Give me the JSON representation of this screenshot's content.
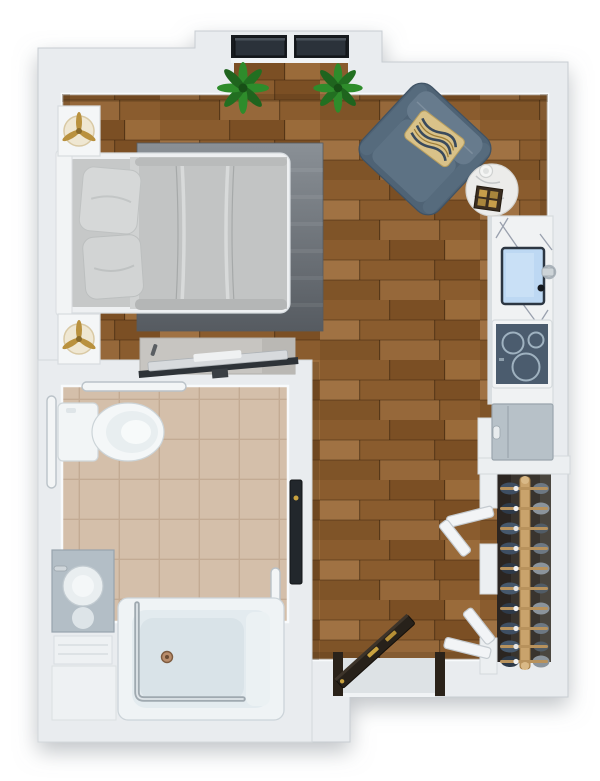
{
  "scene": {
    "type": "apartment-floor-plan-top-view",
    "description": "3D rendered top-down studio apartment floor plan, no text labels",
    "rooms": [
      {
        "name": "main-living-bedroom",
        "floor": "hardwood"
      },
      {
        "name": "bathroom",
        "floor": "beige-tile"
      },
      {
        "name": "closet",
        "floor": "dark"
      },
      {
        "name": "kitchenette",
        "floor": "hardwood"
      },
      {
        "name": "entry",
        "floor": "hardwood"
      }
    ],
    "furniture": [
      "bed",
      "headboard",
      "pillows",
      "area-rug",
      "nightstand-top",
      "nightstand-bottom",
      "table-lamp-top",
      "table-lamp-bottom",
      "tv-console",
      "television",
      "armchair",
      "accent-pillow",
      "side-table",
      "serving-tray",
      "coffee-cup",
      "potted-plant-left",
      "potted-plant-right",
      "window-left",
      "window-right",
      "kitchen-counter",
      "kitchen-sink",
      "kitchen-faucet",
      "cooktop",
      "refrigerator",
      "closet-rod",
      "clothes-on-hangers",
      "bifold-door-upper",
      "bifold-door-lower",
      "entry-door",
      "bathroom-door",
      "toilet",
      "grab-bar-top",
      "grab-bar-left",
      "grab-bar-right",
      "tub-grab-bar",
      "vanity",
      "vanity-basin",
      "walk-in-bathtub",
      "tub-drain",
      "towel-shelf"
    ]
  },
  "palette": {
    "wall": "#e9ecef",
    "wall_edge": "#c8cdd2",
    "wall_bright": "#f3f5f7",
    "wood_base": "#8a5c2e",
    "wood_dark": "#7b4f24",
    "wood_light": "#9f7143",
    "tile": "#d4bfaa",
    "tile_grout": "#c3ab94",
    "rug_light": "#8a9096",
    "rug_dark": "#565b61",
    "bed_linen": "#c2c4c4",
    "pillow": "#d6d8d8",
    "chair_body": "#4f6375",
    "chair_cushion": "#5d7284",
    "accent_gold": "#d9c289",
    "marble": "#f0f2f3",
    "sink_water": "#bdd8f3",
    "cooktop": "#4b5c6e",
    "appliance": "#b7c1c8",
    "closet_interior": "#39342e",
    "rod_wood": "#c9a36c",
    "clothes_navy": "#3e4e62",
    "clothes_gray": "#8b949c",
    "door_wood": "#27211a",
    "door_dark": "#22272c",
    "plant_green": "#2e8c2b",
    "chrome": "#9fa9b0",
    "gold_hardware": "#c9a23f"
  }
}
